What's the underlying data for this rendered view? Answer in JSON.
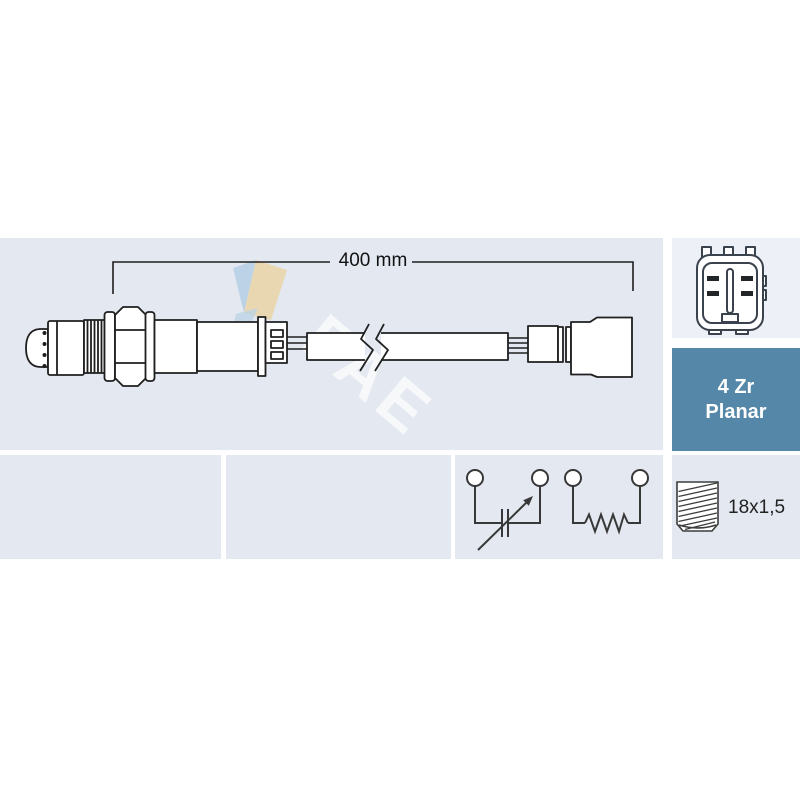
{
  "product": {
    "type_label": "Lambda sensor diagram"
  },
  "diagram": {
    "dimension_label": "400 mm",
    "watermark": "FAE"
  },
  "badge": {
    "line1": "4 Zr",
    "line2": "Planar"
  },
  "specs": {
    "thread_label": "18x1,5"
  },
  "colors": {
    "panel_blue": "#e3e8f1",
    "panel_light": "#edf0f7",
    "badge_bg": "#5587a9",
    "badge_text": "#ffffff",
    "line": "#1f1f1f",
    "logo_blue": "#b3cfe5",
    "logo_tan": "#ebd4a2"
  }
}
